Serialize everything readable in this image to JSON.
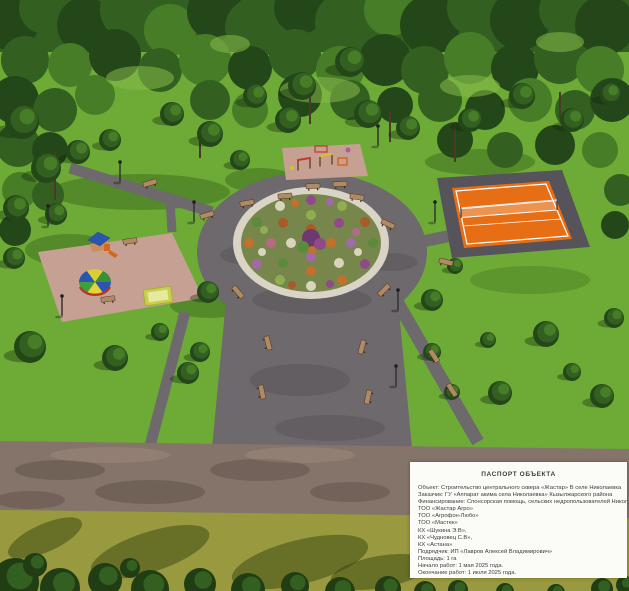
{
  "passport": {
    "title": "ПАСПОРТ ОБЪЕКТА",
    "lines": [
      "Объект: Строительство центрального сквера «Жастар» В селе Николаевка",
      "Заказчик: ГУ «Аппарат акима села Николаевка» Кызылжарского района",
      "Финансирование: Спонсорская помощь, сельских недропользователей Николаевского сельского округа:",
      "ТОО «Жастар Агро»",
      "ТОО «Агрофон-Любо»",
      "ТОО «Мастек»",
      "КХ «Шукина Э.В»,",
      "КХ «Чудновец С.В»,",
      "КХ «Астана»",
      "Подрядчик: ИП «Лавров Алексей Владимирович»",
      "Площадь: 1 га",
      "Начало работ: 1 мая 2025 года.",
      "Окончание работ: 1 июля 2025 года."
    ]
  },
  "colors": {
    "grass": "#6dab36",
    "forest_dark": "#24471a",
    "forest_mid": "#336020",
    "forest_light": "#477d27",
    "path_gray": "#6e696c",
    "sand_pad": "#c6a193",
    "court_orange": "#e66f16",
    "court_apron": "#57535a",
    "court_line": "#ffffff",
    "flowerbed_rim": "#d9d4c6",
    "flowerbed_base": "#77874b",
    "road_dirt": "#85746a",
    "field_olive": "#99993f",
    "bush_dark": "#203d14",
    "bench_wood": "#b08a64",
    "panel_bg": "#fbfbf8",
    "panel_text": "#3d3d3d"
  }
}
